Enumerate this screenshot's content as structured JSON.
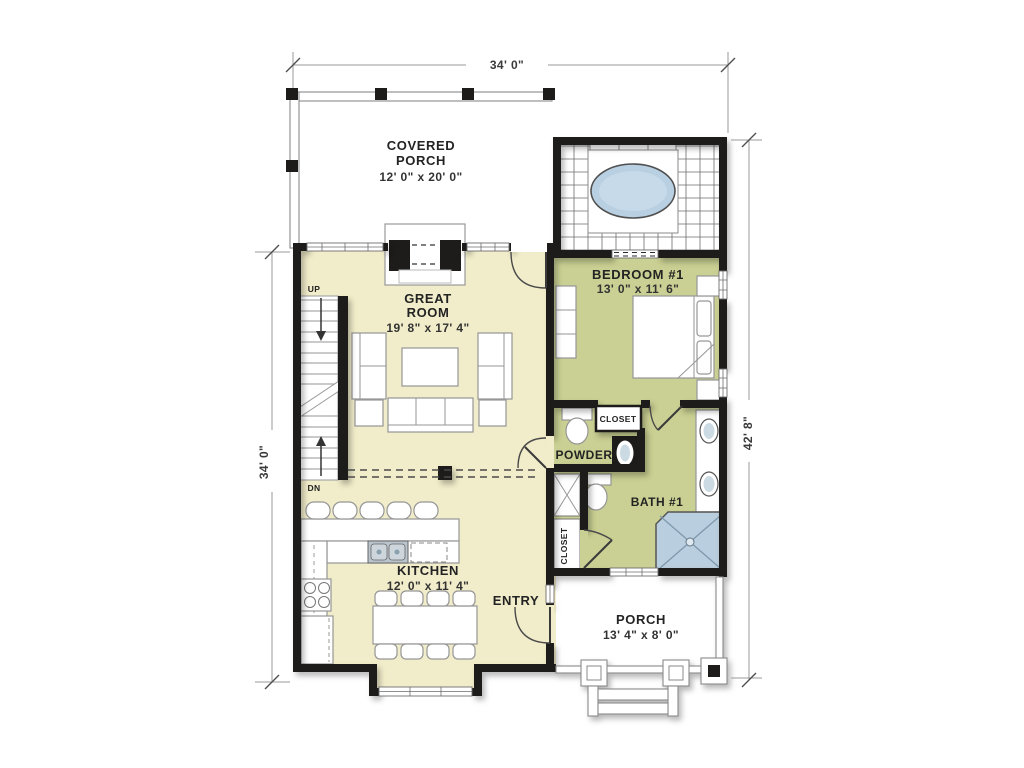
{
  "plan": {
    "rooms": {
      "covered_porch": {
        "lines": [
          "COVERED",
          "PORCH"
        ],
        "dims": "12' 0\" x 20' 0\""
      },
      "great_room": {
        "lines": [
          "GREAT",
          "ROOM"
        ],
        "dims": "19' 8\" x 17' 4\""
      },
      "bedroom_1": {
        "label": "BEDROOM #1",
        "dims": "13' 0\" x 11' 6\""
      },
      "kitchen": {
        "label": "KITCHEN",
        "dims": "12' 0\" x 11' 4\""
      },
      "entry": {
        "label": "ENTRY"
      },
      "porch": {
        "label": "PORCH",
        "dims": "13' 4\" x 8' 0\""
      },
      "powder": {
        "label": "POWDER"
      },
      "bath_1": {
        "label": "BATH #1"
      }
    },
    "closet_labels": [
      "CLOSET",
      "CLOSET"
    ],
    "stair_labels": {
      "up": "UP",
      "down": "DN"
    },
    "dimensions": {
      "top": "34' 0\"",
      "left": "34' 0\"",
      "right": "42' 8\""
    },
    "colors": {
      "floor_cream": "#f1edca",
      "floor_green": "#cad093",
      "wall_black": "#1d1c1a",
      "water_blue": "#b9d0e2",
      "porch_white": "#ffffff",
      "line_gray": "#969696"
    }
  }
}
